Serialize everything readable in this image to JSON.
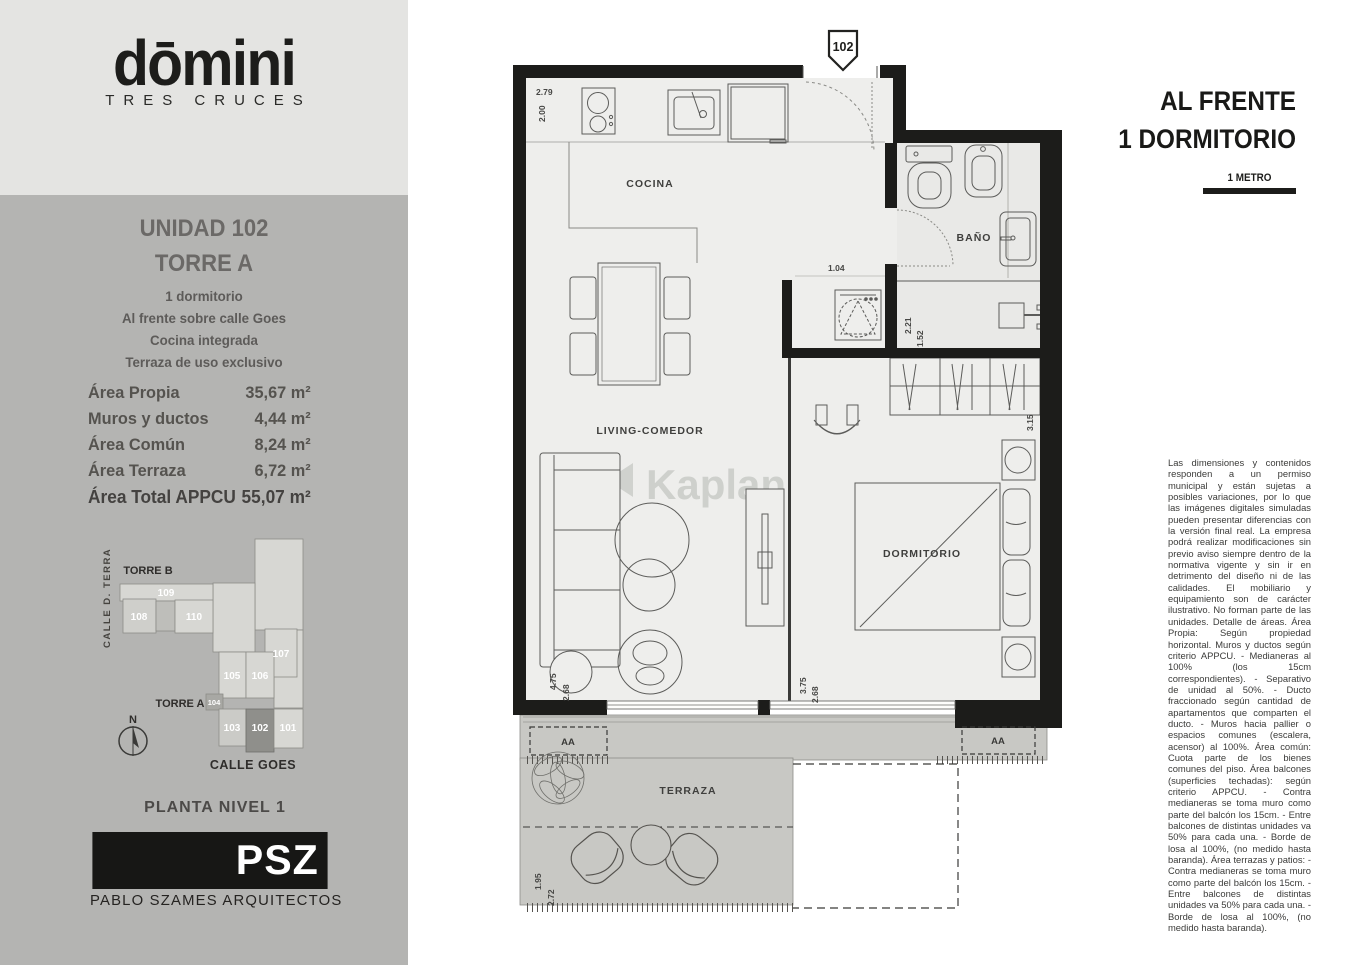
{
  "brand": {
    "logo": "dōmini",
    "sub": "TRES CRUCES"
  },
  "unit": {
    "title": "UNIDAD 102",
    "tower": "TORRE A",
    "features": [
      "1 dormitorio",
      "Al frente sobre calle Goes",
      "Cocina integrada",
      "Terraza de uso exclusivo"
    ]
  },
  "areas": {
    "rows": [
      {
        "label": "Área Propia",
        "value": "35,67 m²"
      },
      {
        "label": "Muros y ductos",
        "value": "4,44 m²"
      },
      {
        "label": "Área Común",
        "value": "8,24 m²"
      },
      {
        "label": "Área Terraza",
        "value": "6,72 m²"
      }
    ],
    "total": {
      "label": "Área Total APPCU",
      "value": "55,07 m²"
    }
  },
  "sitemap": {
    "torre_b": "TORRE B",
    "torre_a": "TORRE A",
    "calle_terra": "CALLE D. TERRA",
    "calle_goes": "CALLE GOES",
    "planta": "PLANTA NIVEL 1",
    "north": "N",
    "units": {
      "u101": "101",
      "u102": "102",
      "u103": "103",
      "u104": "104",
      "u105": "105",
      "u106": "106",
      "u107": "107",
      "u108": "108",
      "u109": "109",
      "u110": "110"
    }
  },
  "architect": {
    "logo": "PSZ",
    "name": "PABLO SZAMES ARQUITECTOS"
  },
  "header": {
    "line1": "AL FRENTE",
    "line2": "1 DORMITORIO",
    "scale": "1 METRO"
  },
  "plan": {
    "marker": "102",
    "watermark": "Kaplan",
    "rooms": {
      "cocina": "COCINA",
      "living": "LIVING-COMEDOR",
      "bano": "BAÑO",
      "dormitorio": "DORMITORIO",
      "terraza": "TERRAZA"
    },
    "dims": {
      "d279": "2.79",
      "d200": "2.00",
      "d104": "1.04",
      "d221": "2.21",
      "d152": "1.52",
      "d315": "3.15",
      "d475": "4.75",
      "d268a": "2.68",
      "d375": "3.75",
      "d268b": "2.68",
      "d195": "1.95",
      "d272": "2.72",
      "ac_left": "AA",
      "ac_right": "AA"
    },
    "colors": {
      "wall": "#1c1c1a",
      "floor": "#eeeeec",
      "terrace": "#c8c8c4",
      "accent_unit": "#8f8f8b"
    }
  },
  "disclaimer": "Las dimensiones y contenidos responden a un permiso municipal y están sujetas a posibles variaciones, por lo que las imágenes digitales simuladas pueden presentar diferencias con la versión final real. La empresa podrá realizar modificaciones sin previo aviso siempre dentro de la normativa vigente y sin ir en detrimento del diseño ni de las calidades. El mobiliario y equipamiento son de carácter ilustrativo. No forman parte de las unidades. Detalle de áreas. Área Propia: Según propiedad horizontal. Muros y ductos según criterio APPCU. - Medianeras al 100% (los 15cm correspondientes). - Separativo de unidad al 50%. - Ducto fraccionado según cantidad de apartamentos que comparten el ducto. - Muros hacia pallier o espacios comunes (escalera, acensor) al 100%. Área común: Cuota parte de los bienes comunes del piso. Área balcones (superficies techadas): según criterio APPCU. - Contra medianeras se toma muro como parte del balcón los 15cm. - Entre balcones de distintas unidades va  50% para cada una. - Borde de losa al 100%, (no medido hasta baranda). Área terrazas y patios: - Contra medianeras se toma muro como parte del balcón los 15cm. - Entre balcones de distintas unidades va  50% para cada una. - Borde de losa al 100%, (no medido hasta baranda)."
}
